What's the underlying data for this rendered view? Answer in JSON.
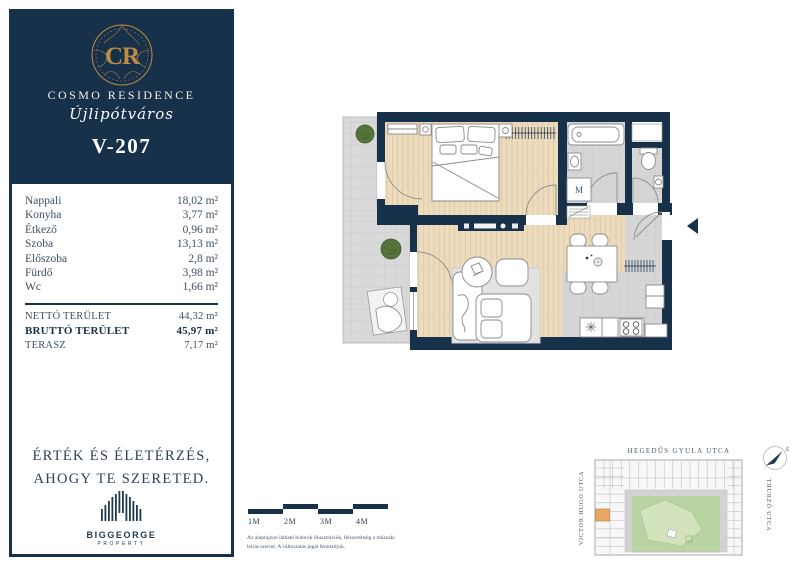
{
  "brand": {
    "monogram": "CR",
    "name": "COSMO RESIDENCE",
    "district": "Újlipótváros",
    "unit_id": "V-207",
    "navy": "#17314b",
    "gold": "#bf8c41"
  },
  "rooms": [
    {
      "label": "Nappali",
      "value": "18,02 m²"
    },
    {
      "label": "Konyha",
      "value": "3,77 m²"
    },
    {
      "label": "Étkező",
      "value": "0,96 m²"
    },
    {
      "label": "Szoba",
      "value": "13,13 m²"
    },
    {
      "label": "Előszoba",
      "value": "2,8 m²"
    },
    {
      "label": "Fürdő",
      "value": "3,98 m²"
    },
    {
      "label": "Wc",
      "value": "1,66 m²"
    }
  ],
  "totals": [
    {
      "label": "NETTÓ TERÜLET",
      "value": "44,32 m²"
    },
    {
      "label": "BRUTTÓ TERÜLET",
      "value": "45,97 m²"
    },
    {
      "label": "TERASZ",
      "value": "7,17 m²"
    }
  ],
  "slogan": {
    "line1": "ÉRTÉK ÉS ÉLETÉRZÉS,",
    "line2": "AHOGY TE SZERETED."
  },
  "developer": {
    "name": "BIGGEORGE",
    "sub": "PROPERTY"
  },
  "floorplan": {
    "washer_label": "M",
    "wall_color": "#17314b",
    "wood_color": "#ecdcbd",
    "tile_color": "#d6d6d6",
    "terrace_color": "#d9d9d9"
  },
  "scalebar": {
    "labels": [
      "1M",
      "2M",
      "3M",
      "4M"
    ]
  },
  "disclaimer": {
    "text": "Az alaprajzon látható bútorok illusztrációk, felszereltség a műszaki leírás szerint. A változtatás jogát fenntartjuk."
  },
  "map": {
    "street_top": "HEGEDŰS GYULA UTCA",
    "street_left": "VICTOR HUGO UTCA",
    "street_right": "THURZÓ UTCA",
    "compass_label": "É",
    "highlight_color": "#e9a761",
    "courtyard_color": "#b9d3a3"
  }
}
